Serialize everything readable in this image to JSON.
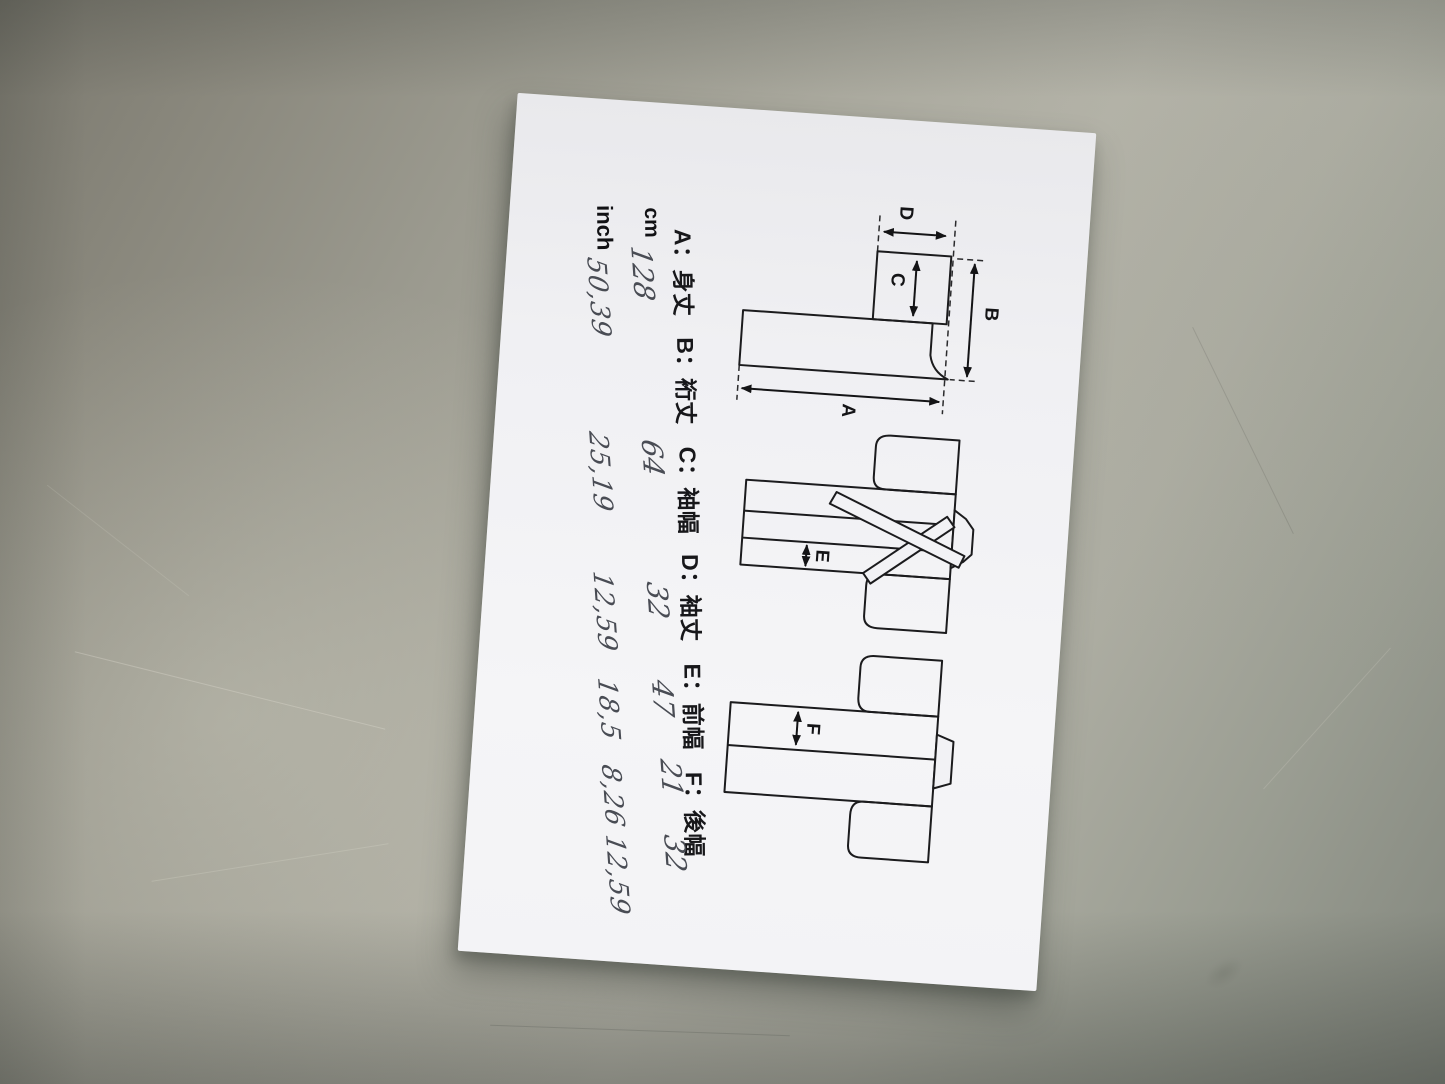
{
  "colors": {
    "surface": "#a5a49a",
    "paper": "#f2f1f4",
    "printed_ink": "#17171a",
    "pen_ink": "#494c54"
  },
  "paper": {
    "legend": {
      "separator": "：",
      "items": [
        {
          "key": "A",
          "name": "身丈"
        },
        {
          "key": "B",
          "name": "裄丈"
        },
        {
          "key": "C",
          "name": "袖幅"
        },
        {
          "key": "D",
          "name": "袖丈"
        },
        {
          "key": "E",
          "name": "前幅"
        },
        {
          "key": "F",
          "name": "後幅"
        }
      ]
    },
    "size_table": {
      "rows": [
        {
          "unit": "cm",
          "values": [
            "128",
            "64",
            "32",
            "47",
            "21",
            "32"
          ]
        },
        {
          "unit": "inch",
          "values": [
            "50,39",
            "25,19",
            "12,59",
            "18,5",
            "8,26",
            "12,59"
          ]
        }
      ]
    }
  }
}
